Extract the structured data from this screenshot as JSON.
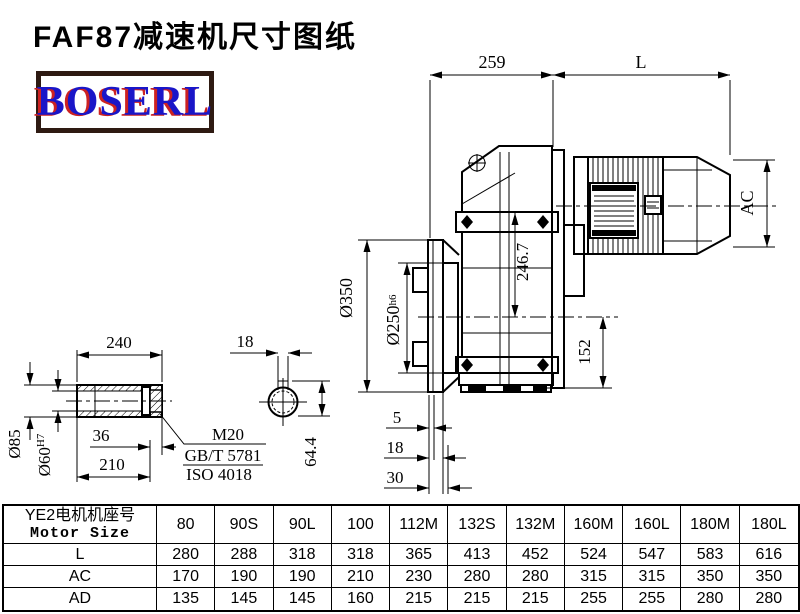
{
  "title": "FAF87减速机尺寸图纸",
  "logo": {
    "text": "BOSERL"
  },
  "colors": {
    "line": "#000000",
    "logo_blue": "#1a16c8",
    "logo_red": "#cc2222",
    "logo_border": "#2e1a12"
  },
  "drawing": {
    "dims": {
      "d259": "259",
      "L": "L",
      "AC": "AC",
      "d246_7": "246.7",
      "d152": "152",
      "d350": "Ø350",
      "d250": "Ø250",
      "d250_tol": "h6",
      "d5": "5",
      "d18_flange": "18",
      "d30": "30",
      "d240": "240",
      "d85": "Ø85",
      "d60": "Ø60",
      "d60_tol": "H7",
      "d36": "36",
      "d210": "210",
      "m20": "M20",
      "gbt": "GB/T 5781",
      "iso": "ISO 4018",
      "key18": "18",
      "d64_4": "64.4"
    }
  },
  "table": {
    "header_cn": "YE2电机机座号",
    "header_en": "Motor Size",
    "columns": [
      "80",
      "90S",
      "90L",
      "100",
      "112M",
      "132S",
      "132M",
      "160M",
      "160L",
      "180M",
      "180L"
    ],
    "rows": [
      {
        "label": "L",
        "values": [
          "280",
          "288",
          "318",
          "318",
          "365",
          "413",
          "452",
          "524",
          "547",
          "583",
          "616"
        ]
      },
      {
        "label": "AC",
        "values": [
          "170",
          "190",
          "190",
          "210",
          "230",
          "280",
          "280",
          "315",
          "315",
          "350",
          "350"
        ]
      },
      {
        "label": "AD",
        "values": [
          "135",
          "145",
          "145",
          "160",
          "215",
          "215",
          "215",
          "255",
          "255",
          "280",
          "280"
        ]
      }
    ]
  }
}
